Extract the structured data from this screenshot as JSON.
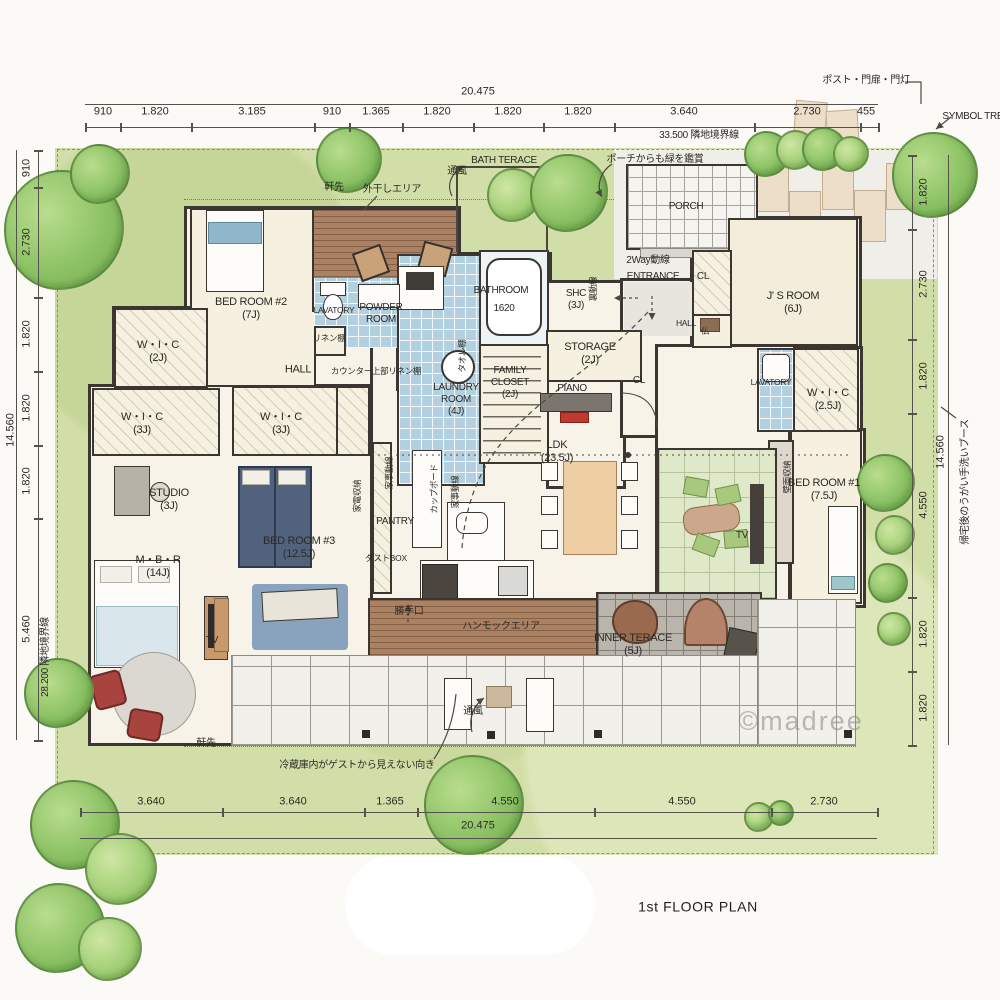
{
  "meta": {
    "title": "1st FLOOR PLAN",
    "watermark": "©madree"
  },
  "site": {
    "boundary_top_label": "33.500 隣地境界線",
    "boundary_left_label": "28.200 隣地境界線",
    "gate_note": "ポスト・門扉・門灯",
    "symbol_tree_label": "SYMBOL TREE",
    "handwash_note": "帰宅後のうがい手洗いブース"
  },
  "dimensions": {
    "top": {
      "overall": "20.475",
      "segments": [
        "910",
        "1.820",
        "3.185",
        "910",
        "1.365",
        "1.820",
        "1.820",
        "1.820",
        "3.640",
        "2.730",
        "455"
      ]
    },
    "bottom": {
      "overall": "20.475",
      "segments": [
        "3.640",
        "3.640",
        "1.365",
        "4.550",
        "4.550",
        "2.730"
      ]
    },
    "left": {
      "overall": "14.560",
      "segments": [
        "910",
        "2.730",
        "1.820",
        "1.820",
        "1.820",
        "5.460"
      ]
    },
    "right": {
      "overall": "14.560",
      "segments": [
        "1.820",
        "2.730",
        "1.820",
        "4.550",
        "1.820",
        "1.820"
      ]
    }
  },
  "colors": {
    "lawn": "#d2dea7",
    "tree": "#8cc265",
    "wall": "#3b3631",
    "tile_blue": "#b3d0e0",
    "tatami": "#dfe8c8",
    "wood_deck": "#ab8163",
    "terrace": "#b9b5ac",
    "accent_red": "#c0392f",
    "dining": "#eecda2",
    "bed_navy": "#51627f"
  },
  "labels": [
    {
      "n": "room-label-bedroom2",
      "t": "BED ROOM #2\n(7J)",
      "x": 251,
      "y": 309
    },
    {
      "n": "room-label-wic-2j",
      "t": "W・I・C\n(2J)",
      "x": 158,
      "y": 352
    },
    {
      "n": "room-label-wic-3j-west",
      "t": "W・I・C\n(3J)",
      "x": 142,
      "y": 424
    },
    {
      "n": "room-label-wic-3j-mid",
      "t": "W・I・C\n(3J)",
      "x": 281,
      "y": 424
    },
    {
      "n": "room-label-studio",
      "t": "STUDIO\n(3J)",
      "x": 169,
      "y": 500
    },
    {
      "n": "room-label-mbr",
      "t": "M・B・R\n(14J)",
      "x": 158,
      "y": 567
    },
    {
      "n": "room-label-bedroom3",
      "t": "BED ROOM #3\n(12.5J)",
      "x": 299,
      "y": 548
    },
    {
      "n": "room-label-hall",
      "t": "HALL",
      "x": 298,
      "y": 370
    },
    {
      "n": "label-counter-linen",
      "t": "カウンター上部リネン棚",
      "x": 376,
      "y": 371,
      "c": "xs"
    },
    {
      "n": "room-label-lavatory-west",
      "t": "LAVATORY",
      "x": 334,
      "y": 310,
      "c": "xs"
    },
    {
      "n": "room-label-powder",
      "t": "POWDER\nROOM",
      "x": 381,
      "y": 314,
      "c": "s"
    },
    {
      "n": "label-linen-shelf",
      "t": "リネン棚",
      "x": 329,
      "y": 338,
      "c": "xs"
    },
    {
      "n": "room-label-laundry",
      "t": "LAUNDRY\nROOM\n(4J)",
      "x": 456,
      "y": 400,
      "c": "s"
    },
    {
      "n": "room-label-bathroom",
      "t": "BATHROOM",
      "x": 501,
      "y": 291,
      "c": "s"
    },
    {
      "n": "label-bath-size",
      "t": "1620",
      "x": 504,
      "y": 309,
      "c": "s"
    },
    {
      "n": "room-label-shc",
      "t": "SHC\n(3J)",
      "x": 576,
      "y": 300,
      "c": "s"
    },
    {
      "n": "room-label-storage",
      "t": "STORAGE\n(2J)",
      "x": 590,
      "y": 354
    },
    {
      "n": "room-label-family-closet",
      "t": "FAMILY\nCLOSET\n(2J)",
      "x": 510,
      "y": 383,
      "c": "s"
    },
    {
      "n": "label-piano",
      "t": "PIANO",
      "x": 572,
      "y": 389,
      "c": "s"
    },
    {
      "n": "room-label-ldk",
      "t": "LDK\n(23.5J)",
      "x": 557,
      "y": 452
    },
    {
      "n": "label-pantry",
      "t": "PANTRY",
      "x": 395,
      "y": 522,
      "c": "s"
    },
    {
      "n": "label-dustbox",
      "t": "ダストBOX",
      "x": 386,
      "y": 558,
      "c": "xs"
    },
    {
      "n": "room-label-entrance",
      "t": "ENTRANCE",
      "x": 653,
      "y": 277,
      "c": "s"
    },
    {
      "n": "label-2way-line",
      "t": "2Way動線",
      "x": 648,
      "y": 261,
      "c": "s"
    },
    {
      "n": "room-label-porch",
      "t": "PORCH",
      "x": 686,
      "y": 207,
      "c": "s"
    },
    {
      "n": "label-cl-jsroom",
      "t": "CL",
      "x": 703,
      "y": 277,
      "c": "s"
    },
    {
      "n": "room-label-jsroom",
      "t": "J' S ROOM\n(6J)",
      "x": 793,
      "y": 303
    },
    {
      "n": "label-hall-east",
      "t": "HALL",
      "x": 686,
      "y": 323,
      "c": "xs"
    },
    {
      "n": "label-butsudan",
      "t": "仏",
      "x": 705,
      "y": 331,
      "c": "xs"
    },
    {
      "n": "label-cl-hall",
      "t": "CL",
      "x": 639,
      "y": 381,
      "c": "s"
    },
    {
      "n": "room-label-lavatory-east",
      "t": "LAVATORY",
      "x": 771,
      "y": 382,
      "c": "xs"
    },
    {
      "n": "room-label-wic-25j",
      "t": "W・I・C\n(2.5J)",
      "x": 828,
      "y": 400
    },
    {
      "n": "room-label-bedroom1",
      "t": "BED ROOM #1\n(7.5J)",
      "x": 824,
      "y": 490
    },
    {
      "n": "label-tv-east",
      "t": "TV",
      "x": 742,
      "y": 536,
      "c": "s"
    },
    {
      "n": "label-tv-west",
      "t": "TV",
      "x": 212,
      "y": 641,
      "c": "s"
    },
    {
      "n": "room-label-inner-terrace",
      "t": "INNER TERACE\n(5J)",
      "x": 633,
      "y": 645
    },
    {
      "n": "label-kitchen-door",
      "t": "勝手口",
      "x": 409,
      "y": 612,
      "c": "s"
    },
    {
      "n": "label-hammock-area",
      "t": "ハンモックエリア",
      "x": 501,
      "y": 627,
      "c": "s"
    },
    {
      "n": "label-appliance-storage",
      "t": "家電収納",
      "x": 357,
      "y": 496,
      "r": -90,
      "c": "xs"
    },
    {
      "n": "label-cupboard",
      "t": "カップボード",
      "x": 434,
      "y": 489,
      "r": -90,
      "c": "xs"
    },
    {
      "n": "label-kaji-line-1",
      "t": "家事動線",
      "x": 389,
      "y": 473,
      "r": -90,
      "c": "xs"
    },
    {
      "n": "label-kaji-line-2",
      "t": "家事動線",
      "x": 455,
      "y": 492,
      "r": -90,
      "c": "xs"
    },
    {
      "n": "label-wall-storage",
      "t": "壁面収納",
      "x": 787,
      "y": 477,
      "r": -90,
      "c": "xs"
    },
    {
      "n": "label-ura-dousen",
      "t": "裏動線",
      "x": 593,
      "y": 289,
      "r": -90,
      "c": "xs"
    },
    {
      "n": "label-towel-shelf",
      "t": "タオル棚",
      "x": 462,
      "y": 356,
      "r": -90,
      "c": "xs"
    },
    {
      "n": "label-eaves-top",
      "t": "軒先",
      "x": 334,
      "y": 188,
      "c": "s"
    },
    {
      "n": "label-eaves-bottom",
      "t": "軒先",
      "x": 206,
      "y": 744,
      "c": "s"
    },
    {
      "n": "label-drying-area",
      "t": "外干しエリア",
      "x": 392,
      "y": 190,
      "c": "s"
    },
    {
      "n": "label-vent-top",
      "t": "通風",
      "x": 457,
      "y": 172,
      "c": "s"
    },
    {
      "n": "label-vent-bottom",
      "t": "通風",
      "x": 473,
      "y": 712,
      "c": "s"
    },
    {
      "n": "label-bath-terrace",
      "t": "BATH TERACE",
      "x": 504,
      "y": 161,
      "c": "s"
    },
    {
      "n": "label-porch-green-note",
      "t": "ポーチからも緑を鑑賞",
      "x": 655,
      "y": 160,
      "c": "s"
    },
    {
      "n": "label-gate-note",
      "t": "ポスト・門扉・門灯",
      "x": 866,
      "y": 81,
      "c": "s"
    },
    {
      "n": "label-symbol-tree",
      "t": "SYMBOL TREE",
      "x": 976,
      "y": 117,
      "c": "s"
    },
    {
      "n": "label-boundary-top",
      "t": "33.500 隣地境界線",
      "x": 699,
      "y": 136,
      "c": "s"
    },
    {
      "n": "label-fridge-note",
      "t": "冷蔵庫内がゲストから見えない向き",
      "x": 357,
      "y": 766,
      "c": "s"
    },
    {
      "n": "label-handwash-note",
      "t": "帰宅後のうがい手洗いブース",
      "x": 966,
      "y": 482,
      "r": -90,
      "c": "s"
    },
    {
      "n": "label-boundary-left",
      "t": "28.200 隣地境界線",
      "x": 46,
      "y": 657,
      "r": -90,
      "c": "s"
    }
  ]
}
